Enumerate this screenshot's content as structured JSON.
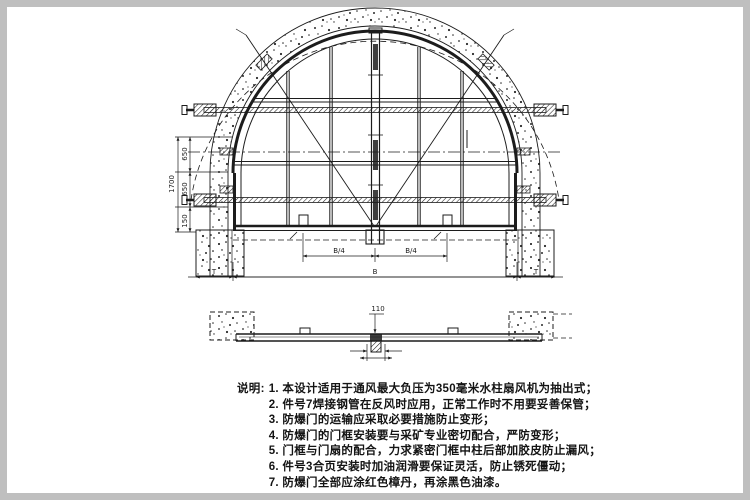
{
  "palette": {
    "ink": "#1c1c1c",
    "frame_gray": "#bfbfbf",
    "paper": "#ffffff"
  },
  "front_view": {
    "dims": {
      "total_height": "1700",
      "seg_top": "650",
      "seg_mid": "650",
      "seg_bottom": "150",
      "quarter_left": "B/4",
      "quarter_right": "B/4",
      "bottom_left": "T",
      "bottom_center": "B",
      "bottom_right": "T"
    }
  },
  "section_view": {
    "dims": {
      "center_height": "110"
    }
  },
  "notes": {
    "label": "说明:",
    "items": [
      "1. 本设计适用于通风最大负压为350毫米水柱扇风机为抽出式；",
      "2. 件号7焊接钢管在反风时应用，正常工作时不用要妥善保管；",
      "3. 防爆门的运输应采取必要措施防止变形；",
      "4. 防爆门的门框安装要与采矿专业密切配合，严防变形；",
      "5. 门框与门扇的配合，力求紧密门框中柱后部加胶皮防止漏风；",
      "6. 件号3合页安装时加油润滑要保证灵活，防止锈死僵动；",
      "7. 防爆门全部应涂红色樟丹，再涂黑色油漆。"
    ]
  }
}
